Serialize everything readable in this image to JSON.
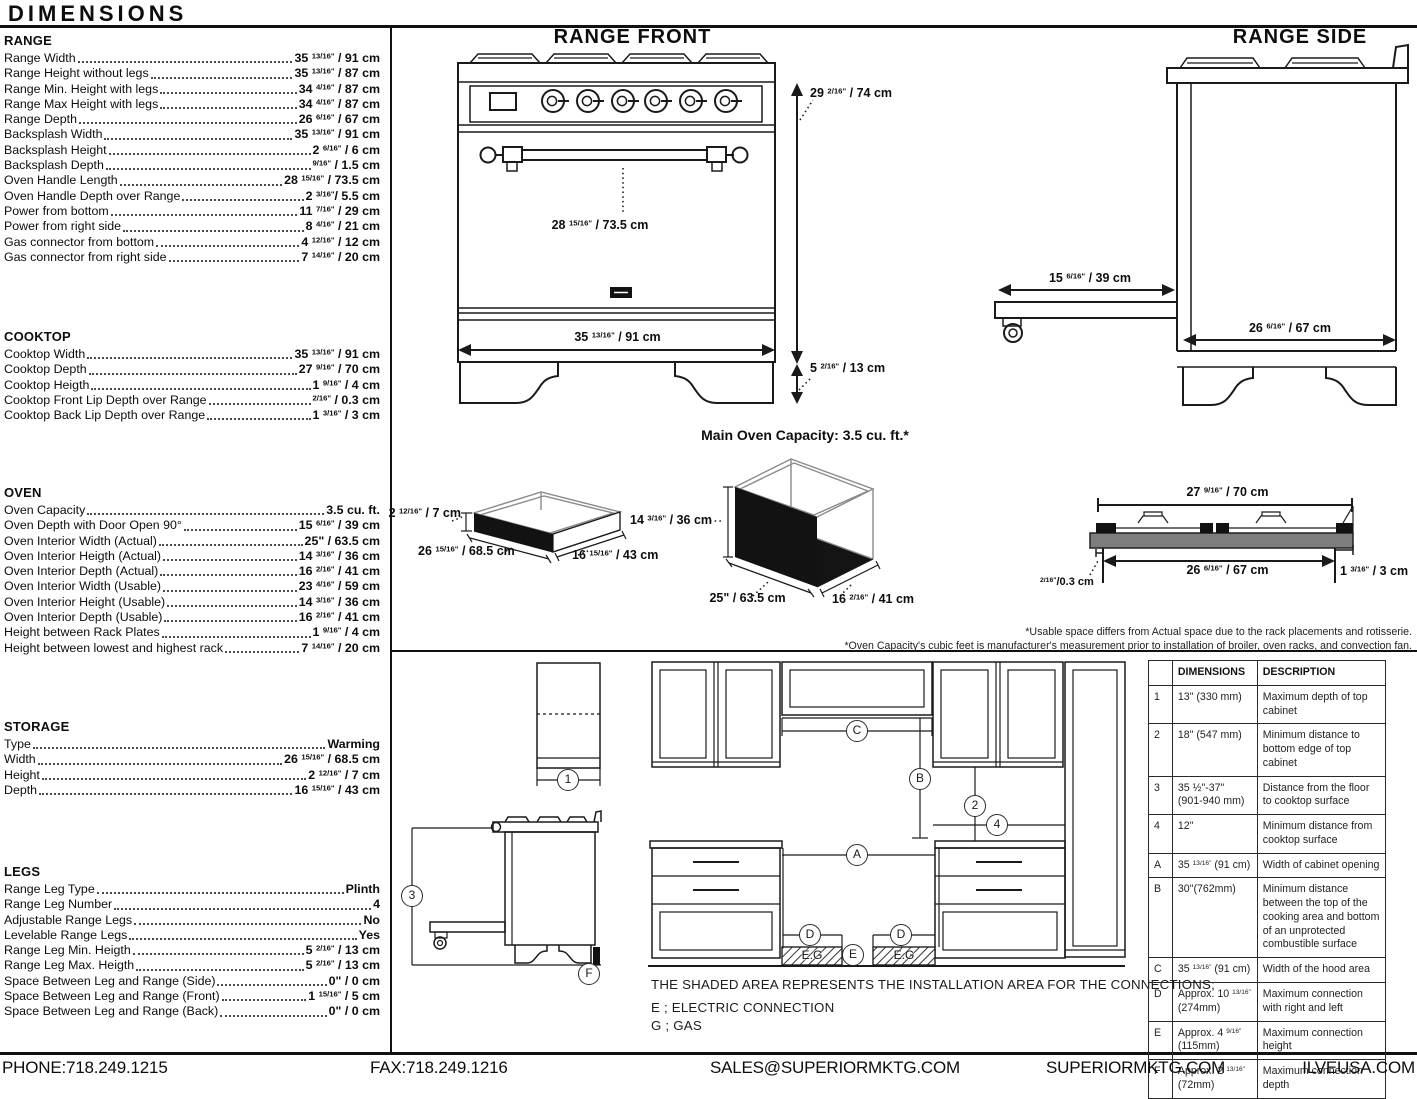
{
  "header": {
    "title": "DIMENSIONS"
  },
  "specs": {
    "range": {
      "title": "RANGE",
      "rows": [
        {
          "label": "Range Width",
          "value": "35 13/16\" / 91 cm"
        },
        {
          "label": "Range Height without legs",
          "value": "35 13/16\" / 87 cm"
        },
        {
          "label": "Range Min. Height with legs",
          "value": "34 4/16\" / 87 cm"
        },
        {
          "label": "Range Max Height with legs",
          "value": "34 4/16\" / 87 cm"
        },
        {
          "label": "Range Depth",
          "value": "26 6/16\" / 67 cm"
        },
        {
          "label": "Backsplash Width",
          "value": "35 13/16\" / 91 cm"
        },
        {
          "label": "Backsplash Height",
          "value": "2 6/16\" / 6 cm"
        },
        {
          "label": "Backsplash Depth",
          "value": "9/16\" / 1.5 cm"
        },
        {
          "label": "Oven Handle Length",
          "value": "28 15/16\" / 73.5 cm"
        },
        {
          "label": "Oven Handle Depth over Range",
          "value": "2 3/16\"/ 5.5 cm"
        },
        {
          "label": "Power from bottom",
          "value": "11 7/16\" / 29 cm"
        },
        {
          "label": "Power from right side",
          "value": "8 4/16\" / 21 cm"
        },
        {
          "label": "Gas connector from bottom",
          "value": "4 12/16\" / 12 cm"
        },
        {
          "label": "Gas connector from right side",
          "value": "7 14/16\" / 20 cm"
        }
      ]
    },
    "cooktop": {
      "title": "COOKTOP",
      "rows": [
        {
          "label": "Cooktop Width",
          "value": "35 13/16\" / 91 cm"
        },
        {
          "label": "Cooktop Depth",
          "value": "27 9/16\" / 70 cm"
        },
        {
          "label": "Cooktop Heigth",
          "value": "1 9/16\" / 4 cm"
        },
        {
          "label": "Cooktop Front Lip Depth over Range",
          "value": "2/16\" / 0.3 cm"
        },
        {
          "label": "Cooktop Back Lip Depth over Range",
          "value": "1 3/16\" / 3 cm"
        }
      ]
    },
    "oven": {
      "title": "OVEN",
      "rows": [
        {
          "label": "Oven Capacity",
          "value": "3.5 cu. ft."
        },
        {
          "label": "Oven Depth with Door Open 90°",
          "value": "15 6/16\" / 39 cm"
        },
        {
          "label": "Oven Interior Width (Actual)",
          "value": "25\" / 63.5 cm"
        },
        {
          "label": "Oven Interior Heigth (Actual)",
          "value": "14 3/16\" / 36 cm"
        },
        {
          "label": "Oven Interior Depth (Actual)",
          "value": "16 2/16\" / 41 cm"
        },
        {
          "label": "Oven Interior Width (Usable)",
          "value": "23 4/16\" / 59 cm"
        },
        {
          "label": "Oven Interior Height (Usable)",
          "value": "14 3/16\" / 36 cm"
        },
        {
          "label": "Oven Interior Depth (Usable)",
          "value": "16 2/16\" / 41 cm"
        },
        {
          "label": "Height between Rack Plates",
          "value": "1 9/16\" / 4 cm"
        },
        {
          "label": "Height between lowest and highest rack",
          "value": "7 14/16\" / 20 cm"
        }
      ]
    },
    "storage": {
      "title": "STORAGE",
      "rows": [
        {
          "label": "Type",
          "value": "Warming"
        },
        {
          "label": "Width",
          "value": "26 15/16\" / 68.5 cm"
        },
        {
          "label": "Height",
          "value": "2 12/16\" / 7 cm"
        },
        {
          "label": "Depth",
          "value": "16 15/16\" / 43 cm"
        }
      ]
    },
    "legs": {
      "title": "LEGS",
      "rows": [
        {
          "label": "Range Leg Type",
          "value": "Plinth"
        },
        {
          "label": "Range Leg Number",
          "value": "4"
        },
        {
          "label": "Adjustable Range Legs",
          "value": "No"
        },
        {
          "label": "Levelable Range Legs",
          "value": "Yes"
        },
        {
          "label": "Range Leg Min. Heigth",
          "value": "5 2/16\" / 13 cm"
        },
        {
          "label": "Range Leg Max. Heigth",
          "value": "5 2/16\" / 13 cm"
        },
        {
          "label": "Space Between Leg and Range (Side)",
          "value": "0\" / 0 cm"
        },
        {
          "label": "Space Between Leg and Range (Front)",
          "value": "1 15/16\" / 5 cm"
        },
        {
          "label": "Space Between Leg and Range (Back)",
          "value": "0\" / 0 cm"
        }
      ]
    }
  },
  "diagrams": {
    "front": {
      "title": "RANGE FRONT",
      "total_height": "29 2/16\" / 74 cm",
      "leg_height": "5 2/16\" / 13 cm",
      "handle_length": "28 15/16\" / 73.5 cm",
      "width": "35 13/16\" / 91 cm"
    },
    "side": {
      "title": "RANGE SIDE",
      "door_open_depth": "15 6/16\" / 39 cm",
      "depth": "26 6/16\" / 67 cm"
    },
    "main_oven_capacity": "Main Oven Capacity: 3.5 cu. ft.*",
    "storage_drawer": {
      "height": "2 12/16\" / 7 cm",
      "width": "26 15/16\" / 68.5 cm",
      "depth": "16 15/16\" / 43 cm"
    },
    "oven_cavity": {
      "height": "14 3/16\" / 36 cm",
      "width": "25\" / 63.5 cm",
      "depth": "16 2/16\" / 41 cm"
    },
    "cooktop_profile": {
      "top_width": "27 9/16\" / 70 cm",
      "burner_area_width": "26 6/16\" / 67 cm",
      "front_lip": "2/16\"/0.3 cm",
      "back_lip": "1 3/16\" / 3 cm"
    },
    "footnotes": [
      "*Usable space differs from Actual space due to the rack placements and rotisserie.",
      "*Oven Capacity's cubic feet is manufacturer's measurement prior to installation of broiler, oven racks, and convection fan."
    ]
  },
  "installation": {
    "markers": {
      "m1": "1",
      "m2": "2",
      "m3": "3",
      "m4": "4",
      "A": "A",
      "B": "B",
      "C": "C",
      "D": "D",
      "E": "E",
      "F": "F"
    },
    "connection_area_label": "E.G",
    "note": "THE SHADED AREA REPRESENTS THE INSTALLATION AREA FOR THE CONNECTIONS;",
    "legend_electric": "E ; ELECTRIC CONNECTION",
    "legend_gas": "G ; GAS",
    "table": {
      "headers": [
        "",
        "DIMENSIONS",
        "DESCRIPTION"
      ],
      "rows": [
        [
          "1",
          "13\" (330 mm)",
          "Maximum depth of top cabinet"
        ],
        [
          "2",
          "18\" (547 mm)",
          "Minimum distance to bottom edge of top cabinet"
        ],
        [
          "3",
          "35 ½\"-37\" (901-940 mm)",
          "Distance from the floor to cooktop surface"
        ],
        [
          "4",
          "12\"",
          "Minimum distance from cooktop surface"
        ],
        [
          "A",
          "35 13/16\" (91 cm)",
          "Width of cabinet opening"
        ],
        [
          "B",
          "30\"(762mm)",
          "Minimum distance between the top of the cooking area and bottom of an unprotected combustible surface"
        ],
        [
          "C",
          "35 13/16\" (91 cm)",
          "Width of the hood area"
        ],
        [
          "D",
          "Approx. 10 13/16\" (274mm)",
          "Maximum connection with right and left"
        ],
        [
          "E",
          "Approx. 4 9/16\" (115mm)",
          "Maximum connection height"
        ],
        [
          "F",
          "Approx. 2 13/16\" (72mm)",
          "Maximum connection depth"
        ]
      ]
    }
  },
  "footer": {
    "phone": "PHONE:718.249.1215",
    "fax": "FAX:718.249.1216",
    "email": "SALES@SUPERIORMKTG.COM",
    "website": "SUPERIORMKTG.COM",
    "website2": "ILVEUSA.COM"
  }
}
